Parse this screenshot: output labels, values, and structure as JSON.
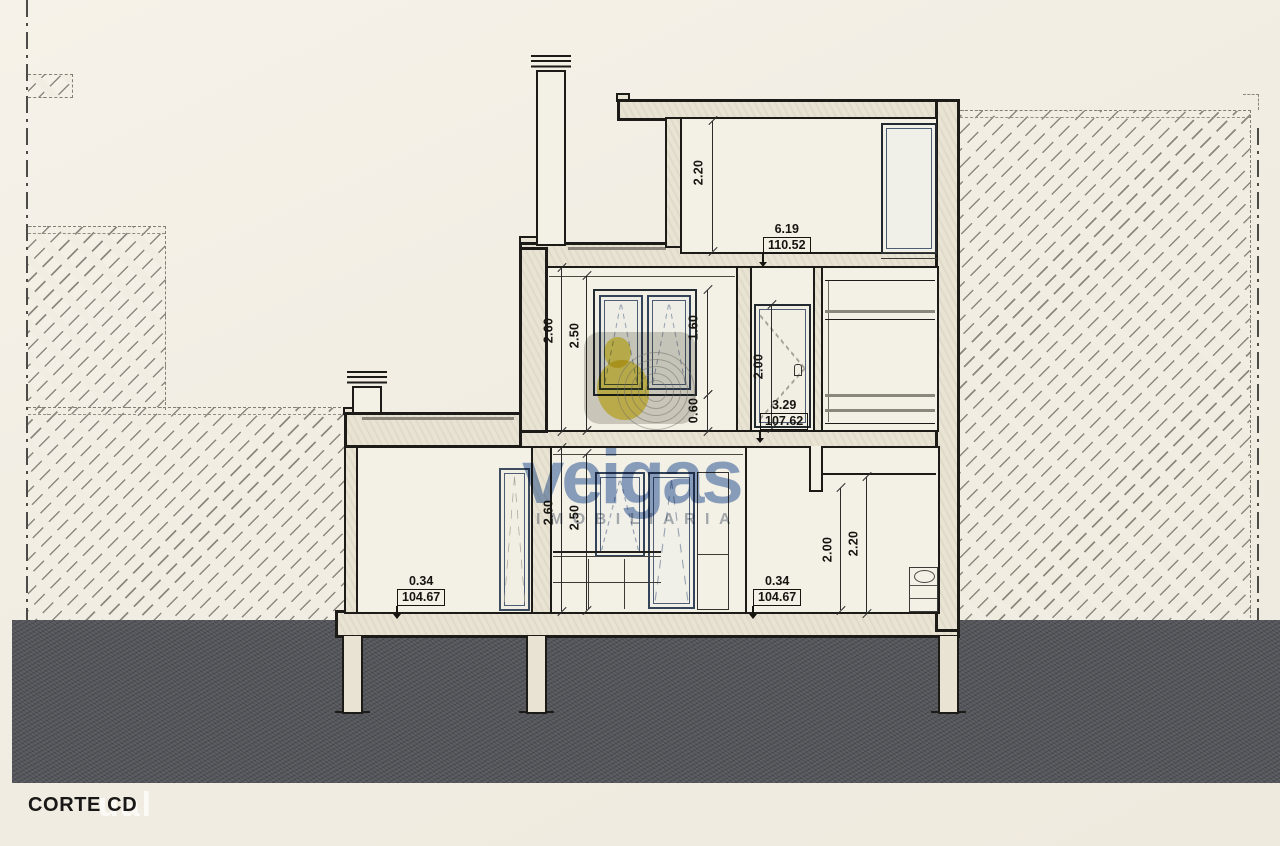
{
  "title": "CORTE CD",
  "watermark": {
    "brand": "veigas",
    "subtitle": "IMOBILIARIA",
    "corner_text": "ual"
  },
  "dims": [
    {
      "id": "top-floor-height",
      "text": "2.20"
    },
    {
      "id": "mid-floor-height",
      "text": "2.60"
    },
    {
      "id": "mid-ceiling-height",
      "text": "2.50"
    },
    {
      "id": "mid-window-height",
      "text": "1.60"
    },
    {
      "id": "mid-window-sill",
      "text": "0.60"
    },
    {
      "id": "mid-door-height",
      "text": "2.00"
    },
    {
      "id": "gf-floor-height",
      "text": "2.60"
    },
    {
      "id": "gf-ceiling-height",
      "text": "2.50"
    },
    {
      "id": "gf-right-door-height",
      "text": "2.00"
    },
    {
      "id": "gf-right-height",
      "text": "2.20"
    }
  ],
  "levels": [
    {
      "id": "roof-terrace-level",
      "top": "6.19",
      "value": "110.52"
    },
    {
      "id": "mid-floor-level",
      "top": "3.29",
      "value": "107.62"
    },
    {
      "id": "gf-level-left",
      "top": "0.34",
      "value": "104.67"
    },
    {
      "id": "gf-level-right",
      "top": "0.34",
      "value": "104.67"
    }
  ],
  "colors": {
    "paper": "#f1ede3",
    "wall_fill": "#e9e3d3",
    "ink": "#1d1b18",
    "ground": "#55565b",
    "joinery_blue": "#33435a",
    "brand_blue": "#26549e",
    "brand_yellow": "#e9d64a"
  }
}
